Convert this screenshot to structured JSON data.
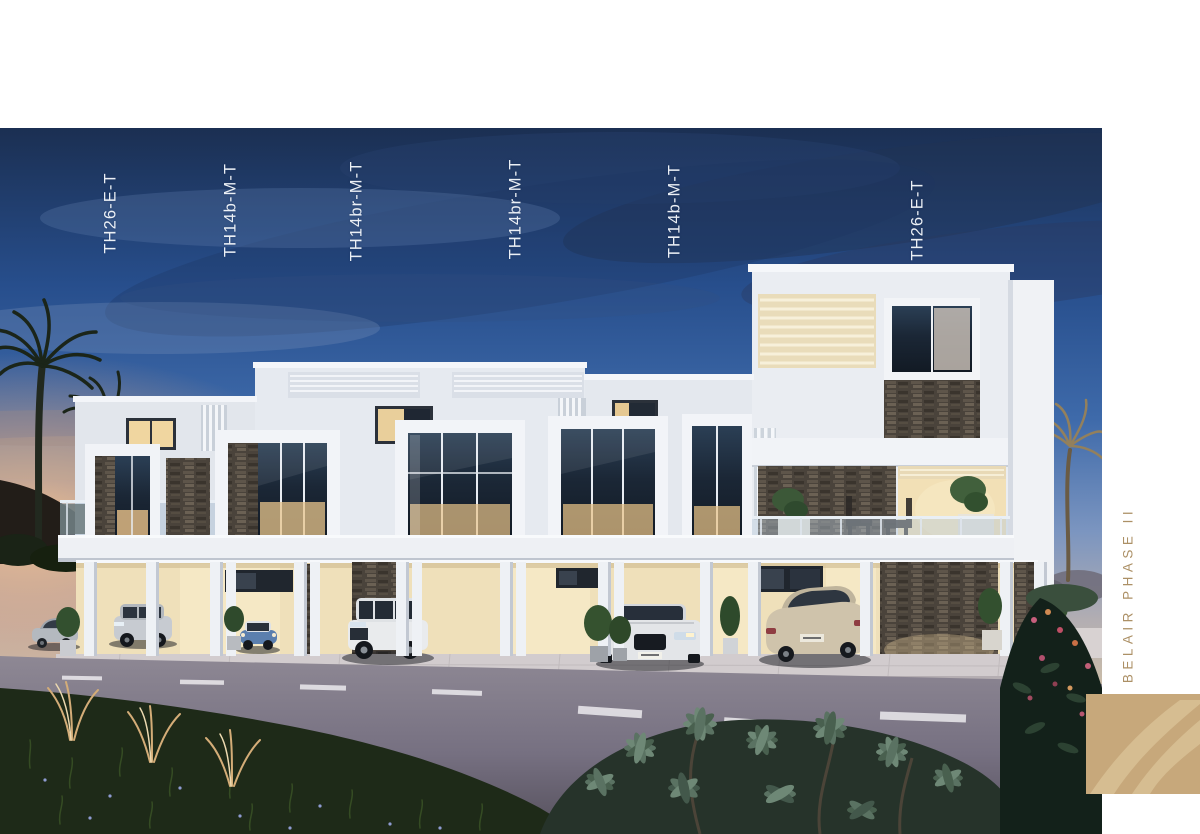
{
  "page": {
    "background_color": "#ffffff"
  },
  "rendering": {
    "description": "Dusk architectural rendering of the Belair Phase II townhouse row: white modern facades with dark stone panels, warm lit interiors, carports with parked cars, road and landscaped foreground, palm trees at dusk",
    "sky_top_color": "#1b2f52",
    "sky_mid_color": "#3e6aaa",
    "sunset_glow_color": "#f6c491",
    "warm_light_color": "#f3e3bd",
    "stone_color": "#4a433b",
    "road_color": "#767081"
  },
  "unit_labels": [
    {
      "label": "TH26-E-T",
      "x": 111,
      "y": 213
    },
    {
      "label": "TH14b-M-T",
      "x": 231,
      "y": 210
    },
    {
      "label": "TH14br-M-T",
      "x": 357,
      "y": 211
    },
    {
      "label": "TH14br-M-T",
      "x": 516,
      "y": 209
    },
    {
      "label": "TH14b-M-T",
      "x": 675,
      "y": 211
    },
    {
      "label": "TH26-E-T",
      "x": 918,
      "y": 220
    }
  ],
  "brand": {
    "vertical_text": "BELAIR PHASE II",
    "text_color": "#ac9066",
    "logo_color": "#c7a87b",
    "logo_swoosh_color": "#e2cda4"
  }
}
